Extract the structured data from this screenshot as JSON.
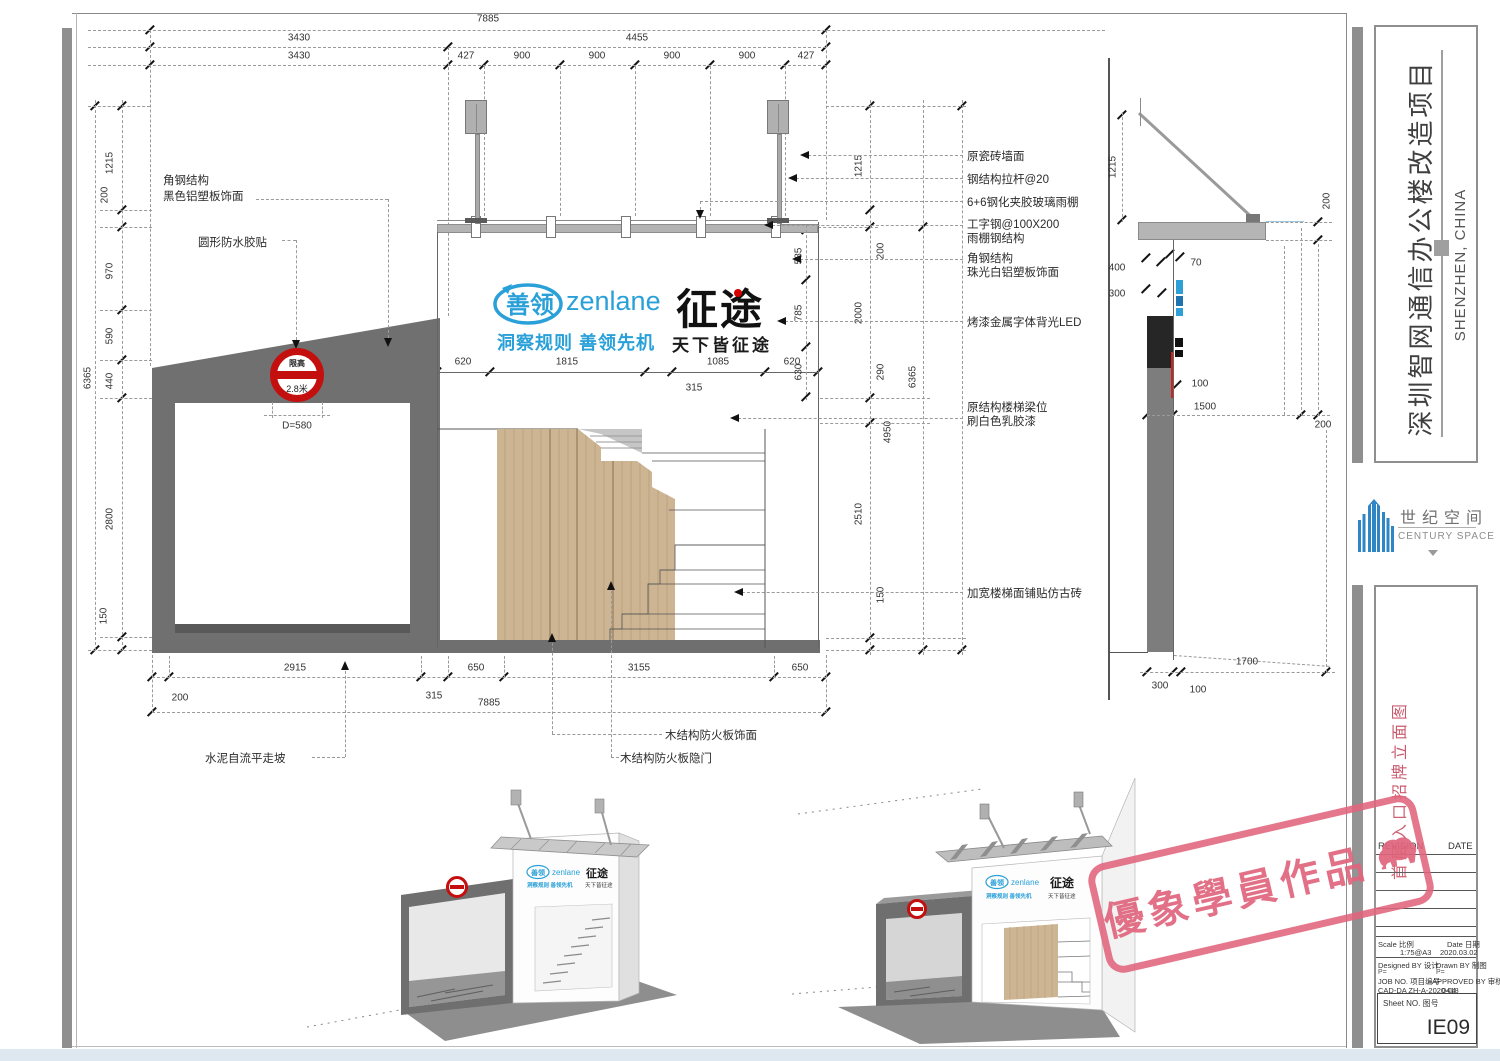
{
  "sheet": {
    "project_title": "深圳智网通信办公楼改造项目",
    "project_location": "SHENZHEN, CHINA",
    "drawing_title": "首层入口招牌立面图",
    "logo_cn": "世纪空间",
    "logo_en": "CENTURY SPACE",
    "revision_label": "REVISION",
    "date_label": "DATE",
    "scale_label": "Scale 比例",
    "scale_value": "1:75@A3",
    "date_field_label": "Date 日期",
    "date_value": "2020.03.02",
    "designed_label": "Designed BY 设计",
    "drawn_label": "Drawn BY 制图",
    "p_left": "P=",
    "p_right": "P=",
    "job_label": "JOB NO. 项目编号",
    "approved_label": "APPROVED BY 审核",
    "cad_label": "CAD-DA ZH-A-2020-04",
    "cad_value": "0418",
    "sheet_no_label": "Sheet NO. 图号",
    "sheet_no": "IE09"
  },
  "watermark": {
    "text": "優象學員作品"
  },
  "sign": {
    "zenlane_cn": "善领",
    "zenlane_en": "zenlane",
    "zenlane_slogan": "洞察规则 善领先机",
    "zhengtu": "征途",
    "zhengtu_slogan": "天下皆征途"
  },
  "limit_sign": {
    "line1": "限高",
    "line2": "2.8米",
    "dia": "D=580"
  },
  "callouts": {
    "left1a": "角钢结构",
    "left1b": "黑色铝塑板饰面",
    "left2": "圆形防水胶贴",
    "right1": "原瓷砖墙面",
    "right2": "钢结构拉杆@20",
    "right3": "6+6钢化夹胶玻璃雨棚",
    "right4a": "工字钢@100X200",
    "right4b": "雨棚钢结构",
    "right5a": "角钢结构",
    "right5b": "珠光白铝塑板饰面",
    "right6": "烤漆金属字体背光LED",
    "right7a": "原结构楼梯梁位",
    "right7b": "刷白色乳胶漆",
    "right8": "加宽楼梯面铺贴仿古砖",
    "bottom1": "水泥自流平走坡",
    "bottom2": "木结构防火板隐门",
    "bottom3": "木结构防火板饰面"
  },
  "dims": {
    "top": {
      "total": "7885",
      "a": "3430",
      "b": "4455",
      "r3": [
        "3430",
        "427",
        "900",
        "900",
        "900",
        "900",
        "427"
      ]
    },
    "left": {
      "total": "6365",
      "segs": [
        "1215",
        "200",
        "970",
        "590",
        "440",
        "2800",
        "150"
      ]
    },
    "right": {
      "total": "6365",
      "span": "4950",
      "segs": [
        "1215",
        "200",
        "2000",
        "290",
        "2510",
        "150"
      ]
    },
    "sign_w": [
      "620",
      "1815",
      "1085",
      "620"
    ],
    "sign_gap": "315",
    "sign_h": [
      "585",
      "785",
      "630"
    ],
    "bottom": {
      "off": "200",
      "segs": [
        "2915",
        "315",
        "650",
        "3155",
        "650"
      ],
      "total": "7885"
    },
    "side": {
      "h1215": "1215",
      "t200": "200",
      "l400": "400",
      "l300": "300",
      "s70": "70",
      "s100": "100",
      "m1500": "1500",
      "m200": "200",
      "b300": "300",
      "b100": "100",
      "b1700": "1700"
    }
  },
  "colors": {
    "accent_blue": "#2aa0d8",
    "sign_red": "#c40f0f",
    "stamp_pink": "#e0647c",
    "wood": "#cdb593",
    "century_blue": "#2f86c4",
    "dark_gray": "#6f6f6f"
  },
  "icons": {
    "watermark_animal": "elephant-icon",
    "century_logo_mark": "building-icon",
    "limit_sign_mark": "no-entry-icon"
  }
}
